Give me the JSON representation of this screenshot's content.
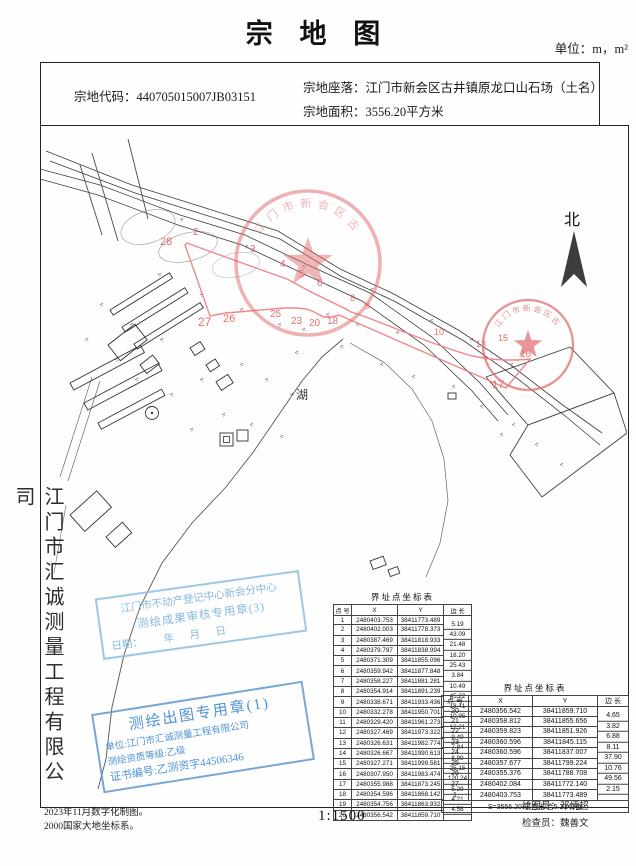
{
  "page": {
    "title": "宗 地 图",
    "unit_label": "单位：m，m²",
    "scale_label": "1:1500"
  },
  "info": {
    "code_label": "宗地代码：",
    "code": "440705015007JB03151",
    "location_label": "宗地座落：",
    "location": "江门市新会区古井镇原龙口山石场（土名）",
    "area_label": "宗地面积：",
    "area": "3556.20平方米"
  },
  "sidebar": {
    "company": "江门市汇诚测量工程有限公司"
  },
  "map": {
    "north_label": "北",
    "lake_label": "湖",
    "seal_text": "江门市新会区古井",
    "vertex_labels": [
      "2",
      "28",
      "3",
      "4",
      "5",
      "6",
      "8",
      "9",
      "10",
      "13",
      "15",
      "16",
      "17",
      "18",
      "20",
      "23",
      "25",
      "26",
      "27"
    ]
  },
  "stamps": {
    "review": {
      "line1": "江门市不动产登记中心新会分中心",
      "line2": "测绘成果审核专用章(3)",
      "line3": "日期：        年      月      日"
    },
    "mapping": {
      "line1": "测绘出图专用章(1)",
      "line2": "单位:江门市汇诚测量工程有限公司",
      "line3": "测绘资质等级:乙级",
      "line4": "证书编号:乙测资字44506346"
    }
  },
  "table1": {
    "title": "界址点坐标表",
    "headers": [
      "点 号",
      "X",
      "Y",
      "边 长"
    ],
    "rows": [
      {
        "n": "1",
        "x": "2480403.753",
        "y": "38411773.489"
      },
      {
        "n": "2",
        "x": "2480402.003",
        "y": "38411778.373"
      },
      {
        "n": "3",
        "x": "2480387.469",
        "y": "38411818.933"
      },
      {
        "n": "4",
        "x": "2480379.797",
        "y": "38411838.994"
      },
      {
        "n": "5",
        "x": "2480371.309",
        "y": "38411855.096"
      },
      {
        "n": "6",
        "x": "2480359.942",
        "y": "38411877.848"
      },
      {
        "n": "7",
        "x": "2480358.227",
        "y": "38411881.281"
      },
      {
        "n": "8",
        "x": "2480354.914",
        "y": "38411891.239"
      },
      {
        "n": "9",
        "x": "2480338.671",
        "y": "38411933.436"
      },
      {
        "n": "10",
        "x": "2480332.278",
        "y": "38411950.701"
      },
      {
        "n": "11",
        "x": "2480329.420",
        "y": "38411961.273"
      },
      {
        "n": "12",
        "x": "2480327.469",
        "y": "38411973.322"
      },
      {
        "n": "13",
        "x": "2480326.631",
        "y": "38411982.774"
      },
      {
        "n": "14",
        "x": "2480326.667",
        "y": "38411990.613"
      },
      {
        "n": "15",
        "x": "2480327.271",
        "y": "38411999.581"
      },
      {
        "n": "16",
        "x": "2480307.950",
        "y": "38411983.474"
      },
      {
        "n": "17",
        "x": "2480355.988",
        "y": "38411873.245"
      },
      {
        "n": "18",
        "x": "2480354.596",
        "y": "38411868.142"
      },
      {
        "n": "19",
        "x": "2480354.756",
        "y": "38411863.932"
      },
      {
        "n": "20",
        "x": "2480356.542",
        "y": "38411859.710"
      }
    ],
    "edges": [
      "5.19",
      "43.09",
      "21.48",
      "18.20",
      "25.43",
      "3.84",
      "10.49",
      "45.22",
      "18.41",
      "10.95",
      "12.21",
      "9.49",
      "7.84",
      "8.99",
      "25.15",
      "120.24",
      "5.29",
      "4.21",
      "4.58"
    ]
  },
  "table2": {
    "title": "界址点坐标表",
    "headers": [
      "点 号",
      "X",
      "Y",
      "边 长"
    ],
    "rows": [
      {
        "n": "20",
        "x": "2480356.542",
        "y": "38411859.710"
      },
      {
        "n": "21",
        "x": "2480358.812",
        "y": "38411855.656"
      },
      {
        "n": "22",
        "x": "2480359.823",
        "y": "38411851.926"
      },
      {
        "n": "23",
        "x": "2480360.596",
        "y": "38411845.115"
      },
      {
        "n": "24",
        "x": "2480360.596",
        "y": "38411837.007"
      },
      {
        "n": "25",
        "x": "2480357.677",
        "y": "38411799.224"
      },
      {
        "n": "26",
        "x": "2480355.376",
        "y": "38411788.708"
      },
      {
        "n": "27",
        "x": "2480402.084",
        "y": "38411772.140"
      },
      {
        "n": "1",
        "x": "2480403.753",
        "y": "38411773.489"
      }
    ],
    "edges": [
      "4.65",
      "3.82",
      "6.88",
      "8.11",
      "37.90",
      "10.76",
      "49.56",
      "2.15"
    ],
    "footer": "S=3556.20 平方米  合5.3343亩"
  },
  "credits": {
    "drafter_label": "绘图员：",
    "drafter": "邓炳超",
    "checker_label": "检查员：",
    "checker": "魏善文"
  },
  "footer": {
    "line1": "2023年11月数字化制图。",
    "line2": "2000国家大地坐标系。"
  }
}
